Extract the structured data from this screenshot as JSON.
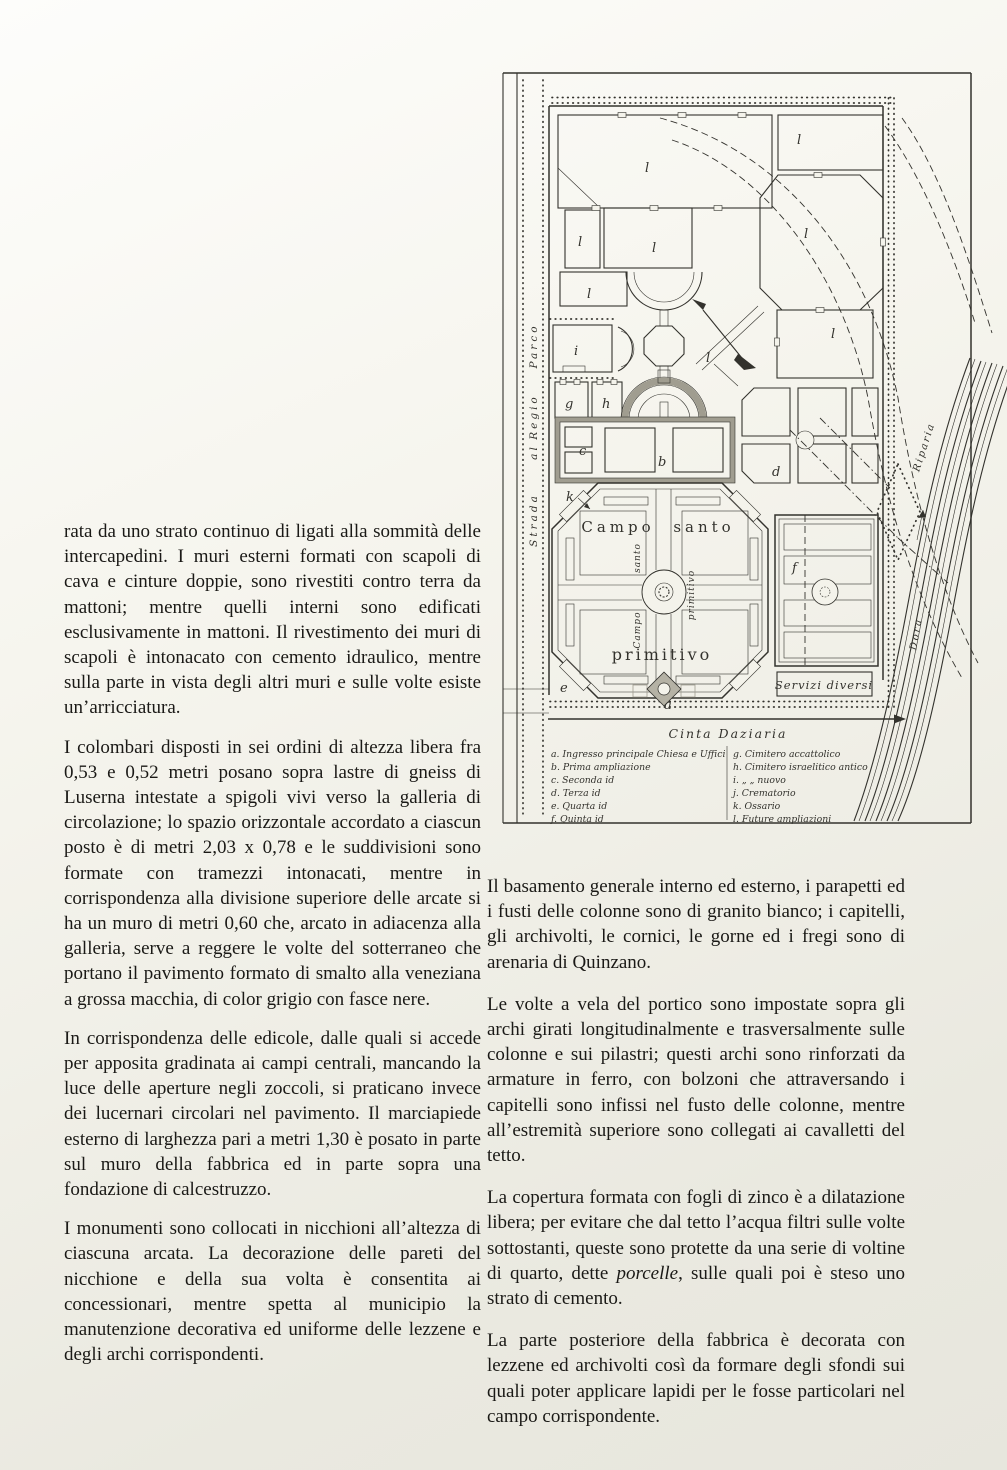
{
  "ink_color": "#1a1916",
  "paper_color": "#efeee6",
  "left_column": {
    "paragraphs": [
      "rata da uno strato continuo di ligati alla sommità delle intercapedini. I muri esterni formati con scapoli di cava e cinture doppie, sono rivestiti contro terra da mattoni; mentre quelli interni sono edificati esclusivamente in mattoni. Il rivestimento dei muri di scapoli è intonacato con cemento idraulico, mentre sulla parte in vista degli altri muri e sulle volte esiste un’arricciatura.",
      "I colombari disposti in sei ordini di altezza libera fra 0,53 e 0,52 metri posano sopra lastre di gneiss di Luserna intestate a spigoli vivi verso la galleria di circolazione; lo spazio orizzontale accordato a ciascun posto è di metri 2,03 x 0,78 e le suddivisioni sono formate con tramezzi intonacati, mentre in corrispondenza alla divisione superiore delle arcate si ha un muro di metri 0,60 che, arcato in adiacenza alla galleria, serve a reggere le volte del sotterraneo che portano il pavimento formato di smalto alla veneziana a grossa macchia, di color grigio con fasce nere.",
      "In corrispondenza delle edicole, dalle quali si accede per apposita gradinata ai campi centrali, mancando la luce delle aperture negli zoccoli, si praticano invece dei lucernari circolari nel pavimento. Il marciapiede esterno di larghezza pari a metri 1,30 è posato in parte sul muro della fabbrica ed in parte sopra una fondazione di calcestruzzo.",
      "I monumenti sono collocati in nicchioni all’altezza di ciascuna arcata. La decorazione delle pareti del nicchione e della sua volta è consentita ai concessionari, mentre spetta al municipio la manutenzione decorativa ed uniforme delle lezzene e degli archi corrispondenti."
    ]
  },
  "right_column": {
    "p1": "Il basamento generale interno ed esterno, i parapetti ed i fusti delle colonne sono di granito bianco; i capitelli, gli archivolti, le cornici, le gorne ed i fregi sono di arenaria di Quinzano.",
    "p2": "Le volte a vela del portico sono impostate sopra gli archi girati longitudinalmente e trasversalmente sulle colonne e sui pilastri; questi archi sono rinforzati da armature in ferro, con bolzoni che attraversando i capitelli sono infissi nel fusto delle colonne, mentre all’estremità superiore sono collegati ai cavalletti del tetto.",
    "p3_before": "La copertura formata con fogli di zinco è a dilatazione libera; per evitare che dal tetto l’acqua filtri sulle volte sottostanti, queste sono protette da una serie di voltine di quarto, dette ",
    "p3_italic": "porcelle",
    "p3_after": ", sulle quali poi è steso uno strato di cemento.",
    "p4": "La parte posteriore della fabbrica è decorata con lezzene ed archivolti così da formare degli sfondi sui quali poter applicare lapidi per le fosse particolari nel campo corrispondente."
  },
  "figure": {
    "street": [
      "Strada",
      "al",
      "Regio",
      "Parco"
    ],
    "river": {
      "name_top": "Riparia",
      "name_bottom": "Dora"
    },
    "campo": {
      "campo": "Campo",
      "santo": "santo",
      "primitivo": "primitivo"
    },
    "servizi": "Servizi diversi",
    "cinta": "Cinta Daziaria",
    "labels": {
      "a": "a",
      "b": "b",
      "c": "c",
      "d": "d",
      "e": "e",
      "f": "f",
      "g": "g",
      "h": "h",
      "i": "i",
      "k": "k",
      "l": "l"
    },
    "legend": {
      "left": [
        "a. Ingresso principale Chiesa e Uffici",
        "b. Prima ampliazione",
        "c. Seconda  id",
        "d. Terza   id",
        "e. Quarta  id",
        "f. Quinta  id"
      ],
      "right": [
        "g. Cimitero accattolico",
        "h. Cimitero israelitico antico",
        "i.   „      „    nuovo",
        "j. Crematorio",
        "k. Ossario",
        "l. Future ampliazioni"
      ]
    }
  }
}
